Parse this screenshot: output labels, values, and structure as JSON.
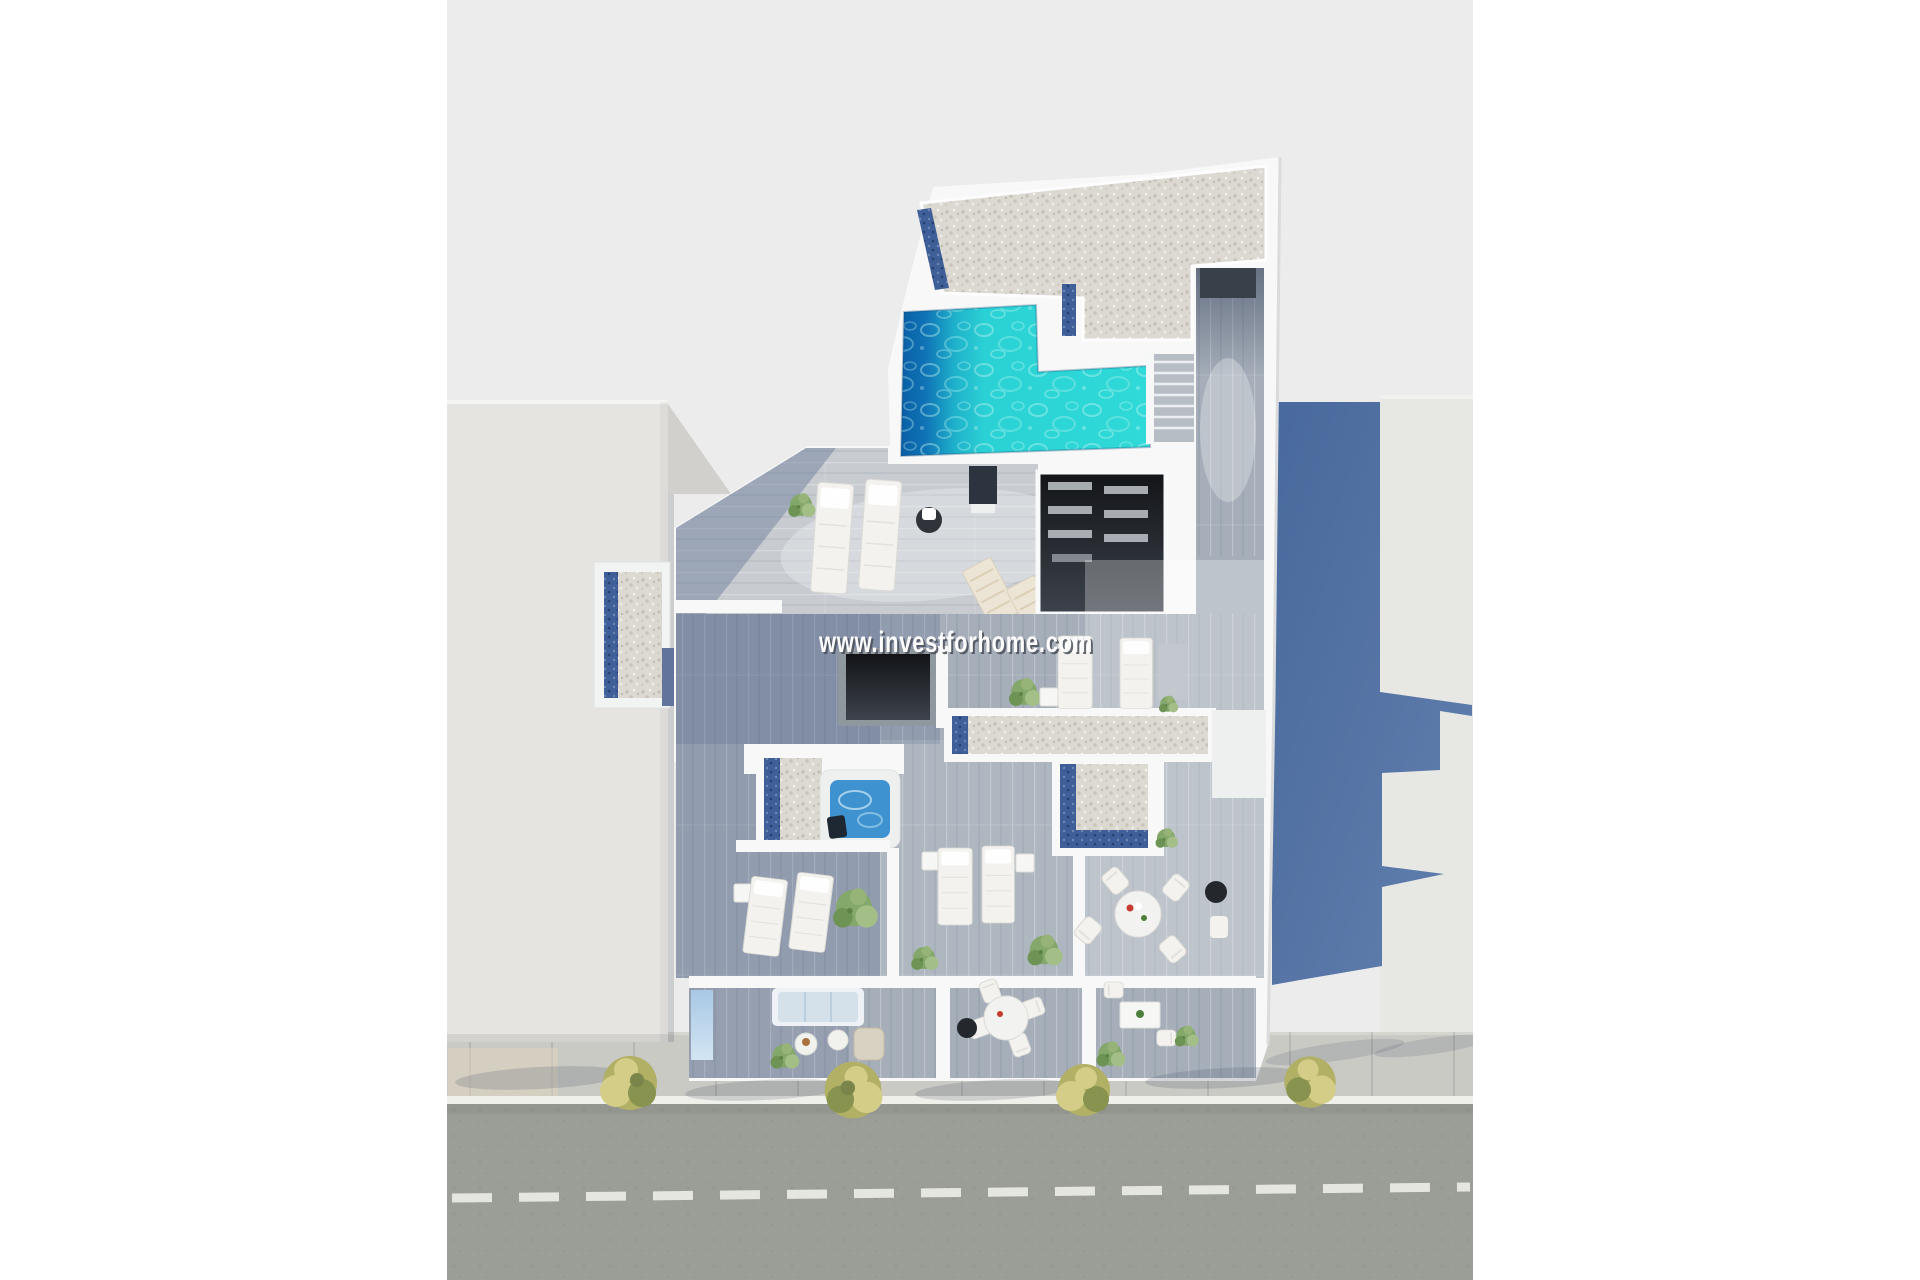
{
  "title": "3D aerial floor plan render of penthouse level with roof pool",
  "watermark": {
    "text": "www.investforhome.com",
    "fill": "#fbfbfb",
    "outline": "#4a505a"
  },
  "scene": {
    "type": "architectural-3d-top-view",
    "ground_label": "ground",
    "street": {
      "label": "street",
      "center_line": "dashed",
      "trees_on_sidewalk": 4
    },
    "neighbor_buildings": {
      "left": "white residential block",
      "right": "light block with cast shadow"
    },
    "main_building": {
      "roof_features": [
        "gravel roof",
        "swimming pool",
        "skylight strips",
        "staircase",
        "wood deck corridor"
      ],
      "terrace_features": [
        "sun loungers",
        "deck chairs",
        "hot tub",
        "stairwell void",
        "skylight void",
        "gravel roof cross",
        "planters"
      ],
      "balcony_features": [
        "sofa",
        "coffee tables",
        "wicker chair",
        "round dining table",
        "barbecue grill",
        "small table with chairs",
        "glass panel"
      ]
    }
  },
  "colors": {
    "margin": "#ffffff",
    "ground": "#ececec",
    "street": "#9b9e97",
    "streetLine": "#e9eae3",
    "curb": "#eff0ea",
    "sidewalk": "#c9cac4",
    "tan": "#ddd3c0",
    "treeMain": "#b2b065",
    "treeLight": "#d4cd88",
    "treeDark": "#87934e",
    "leftBuilding": "#e5e4e1",
    "leftWedge": "#d1d0cc",
    "rightBuilding": "#e7e7e4",
    "shadowA": "#48699c",
    "shadowB": "#627fae",
    "wall": "#f7f8f7",
    "gravel": "#dcd9d2",
    "gravelDot": "#c5bfb3",
    "mosaic": "#3f5f99",
    "deck": "#a5aeb9",
    "deckLight": "#c8ccd1",
    "deckDark": "#6e7f9b",
    "poolDeep": "#0a5ea5",
    "poolMid": "#1fb3cb",
    "poolShallow": "#2fdad8",
    "hotTub": "#3e92cf",
    "darkRoomA": "#121417",
    "darkRoomB": "#3d434c",
    "joist": "#b7bcc2",
    "glassA": "#a8c8e4",
    "glassB": "#d3e5f3",
    "furn": "#f3f2ef",
    "sofa": "#d4e0ea",
    "wicker": "#d8d2c2",
    "grill": "#24272c",
    "plant": "#84a86b",
    "plantLight": "#a3bf87"
  }
}
